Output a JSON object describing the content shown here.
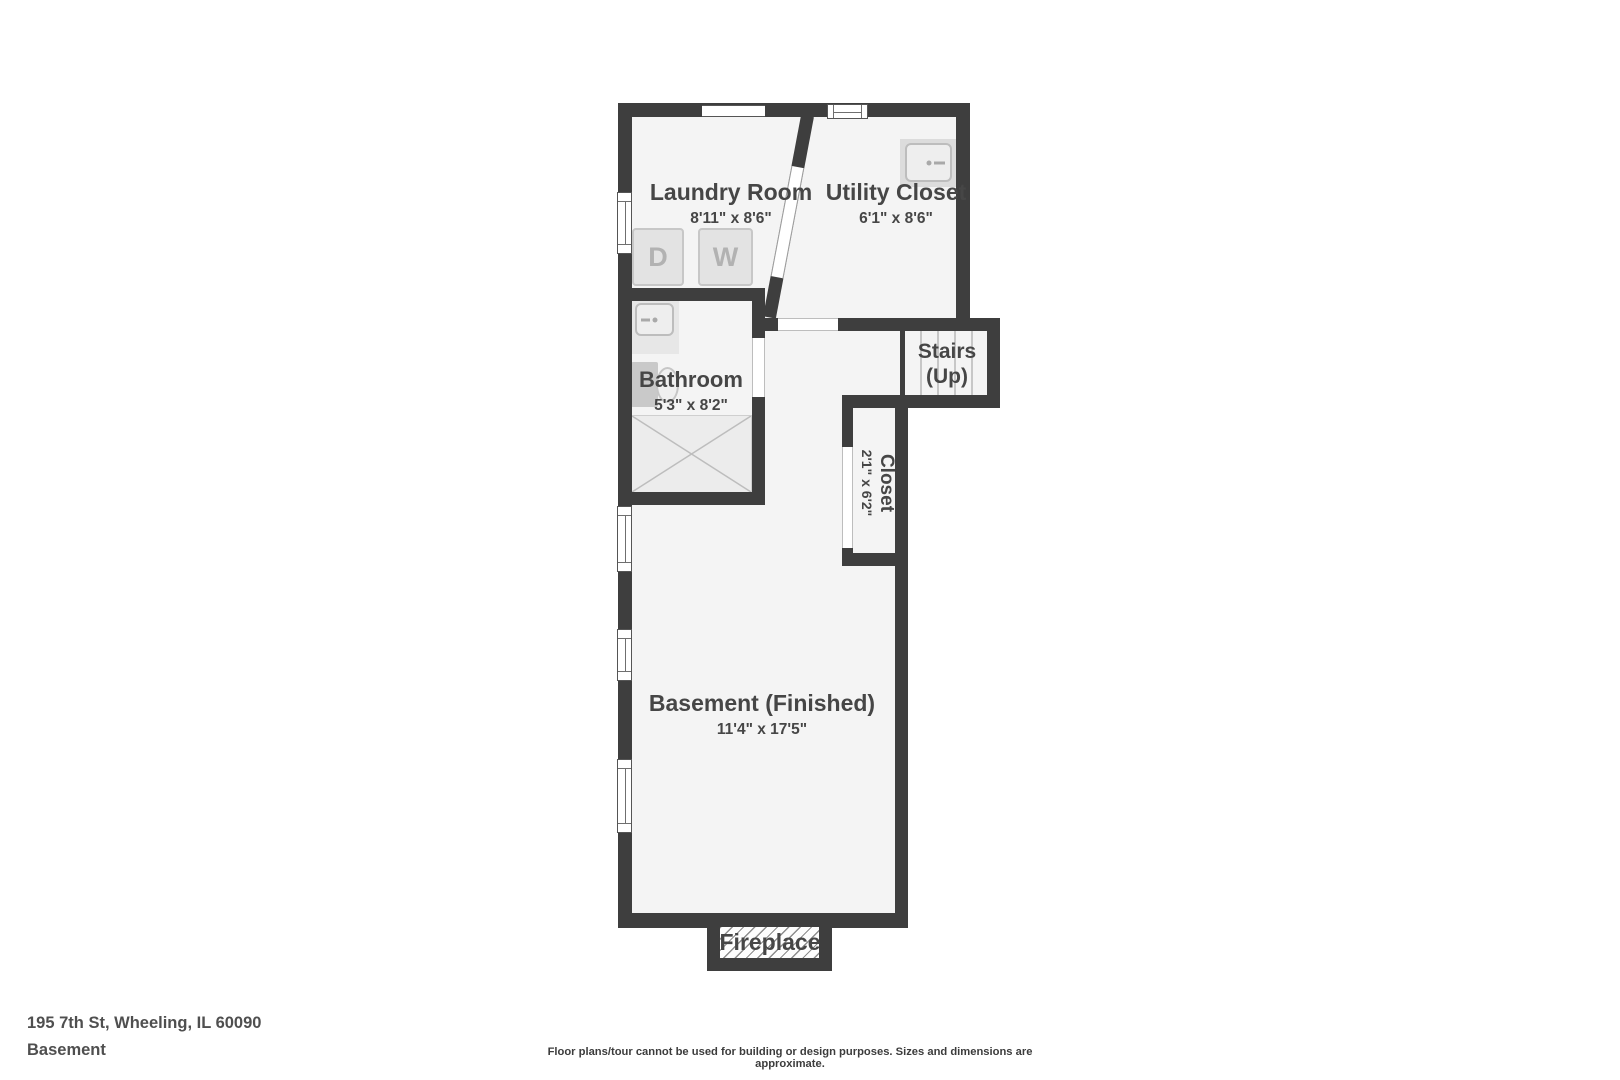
{
  "floorplan": {
    "rooms": {
      "laundry": {
        "name": "Laundry Room",
        "dims": "8'11\" x 8'6\""
      },
      "utility": {
        "name": "Utility Closet",
        "dims": "6'1\" x 8'6\""
      },
      "bathroom": {
        "name": "Bathroom",
        "dims": "5'3\" x 8'2\""
      },
      "stairs": {
        "name": "Stairs",
        "direction": "(Up)"
      },
      "closet": {
        "name": "Closet",
        "dims": "2'1\" x 6'2\""
      },
      "basement": {
        "name": "Basement (Finished)",
        "dims": "11'4\" x 17'5\""
      },
      "fireplace": {
        "name": "Fireplace"
      }
    },
    "appliances": {
      "dryer_label": "D",
      "washer_label": "W"
    }
  },
  "footer": {
    "address": "195 7th St, Wheeling, IL 60090",
    "floor_label": "Basement",
    "disclaimer": "Floor plans/tour cannot be used for building or design purposes. Sizes and dimensions are approximate."
  },
  "colors": {
    "wall": "#3e3e3e",
    "floor": "#f4f4f4",
    "label_text": "#464646",
    "fixture_fill": "#e3e3e3",
    "fixture_border": "#c7c7c7",
    "fixture_letter": "#b2b2b2",
    "window_fill": "#ffffff",
    "hatch_line": "#8d8d8d"
  }
}
